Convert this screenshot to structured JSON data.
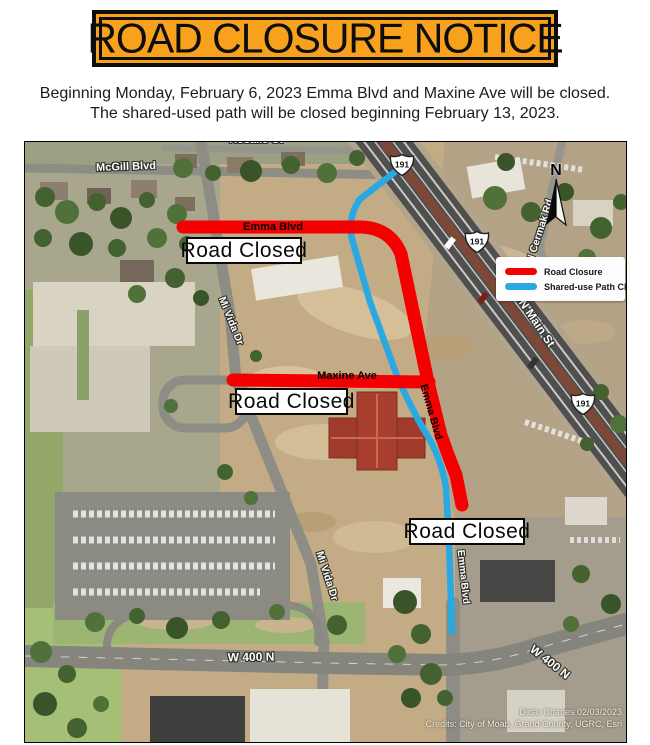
{
  "notice": {
    "title": "ROAD CLOSURE NOTICE",
    "subtitle_line1": "Beginning Monday, February 6, 2023 Emma Blvd and Maxine Ave will be closed.",
    "subtitle_line2": "The shared-used path will be closed beginning February 13, 2023."
  },
  "map": {
    "street_labels": {
      "mcgill": "McGill Blvd",
      "rosalie": "Rosalie Ct",
      "mi_vida_1": "Mi Vida Dr",
      "mi_vida_2": "Mi Vida Dr",
      "cermak": "N Cermak Rd",
      "n_main": "N Main St",
      "emma_street": "Emma Blvd",
      "w400n_1": "W 400 N",
      "w400n_2": "W 400 N"
    },
    "closure_labels": {
      "emma_top": "Emma Blvd",
      "emma_diagonal": "Emma Blvd",
      "maxine": "Maxine Ave"
    },
    "road_closed_boxes": [
      "Road Closed",
      "Road Closed",
      "Road Closed"
    ],
    "highway_shields": [
      "191",
      "191",
      "191"
    ],
    "north_arrow_label": "N",
    "legend": {
      "items": [
        {
          "label": "Road Closure",
          "color": "#f40000"
        },
        {
          "label": "Shared-use Path Closure",
          "color": "#29a8e2"
        }
      ]
    },
    "credits": {
      "line1": "Didar Charles 02/03/2023",
      "line2": "Credits: City of Moab, Grand County, UGRC, Esri"
    }
  },
  "colors": {
    "banner_orange": "#f7a11c",
    "road_closure_red": "#f40000",
    "shared_path_blue": "#29a8e2"
  }
}
